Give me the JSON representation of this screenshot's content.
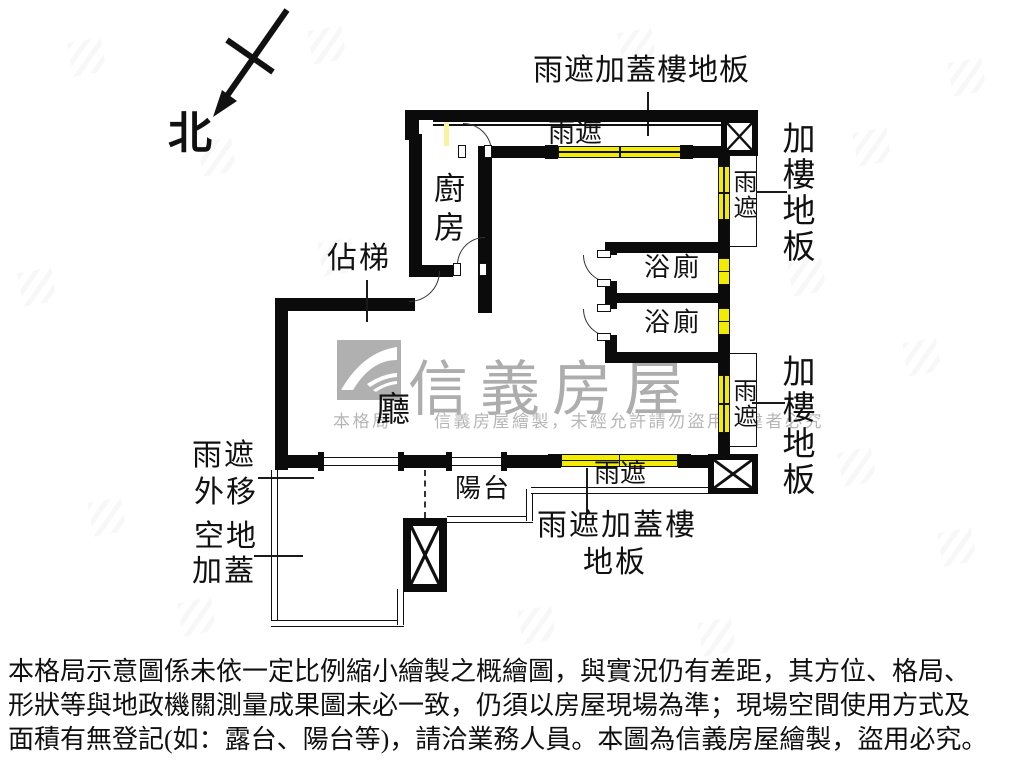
{
  "compass": {
    "north_label": "北"
  },
  "plan": {
    "top_annotation": "雨遮加蓋樓地板",
    "bottom_annotation_line1": "雨遮加蓋樓",
    "bottom_annotation_line2": "地板",
    "right_annotation_upper": "加樓地板",
    "right_annotation_lower": "加樓地板",
    "left_annotation_lines": [
      "雨遮",
      "外移",
      "空地",
      "加蓋"
    ],
    "awning_labels": {
      "top": "雨遮",
      "right_upper": "雨遮",
      "right_lower": "雨遮",
      "bottom": "雨遮"
    },
    "rooms": {
      "kitchen": "廚房",
      "stairs": "佔梯",
      "bath1": "浴廁",
      "bath2": "浴廁",
      "living": "廳",
      "balcony": "陽台"
    }
  },
  "watermark": {
    "brand": "信義房屋",
    "line_prefix": "本格局",
    "line_suffix": "信義房屋繪製，未經允許請勿盜用，違者必究"
  },
  "disclaimer": {
    "line1": "本格局示意圖係未依一定比例縮小繪製之概繪圖，與實況仍有差距，其方位、格局、",
    "line2": "形狀等與地政機關測量成果圖未必一致，仍須以房屋現場為準；現場空間使用方式及",
    "line3": "面積有無登記(如：露台、陽台等)，請洽業務人員。本圖為信義房屋繪製，盜用必究。"
  },
  "colors": {
    "wall_black": "#0b0b0b",
    "awning_yellow": "#f2ec02",
    "watermark_gray": "#adadad"
  }
}
